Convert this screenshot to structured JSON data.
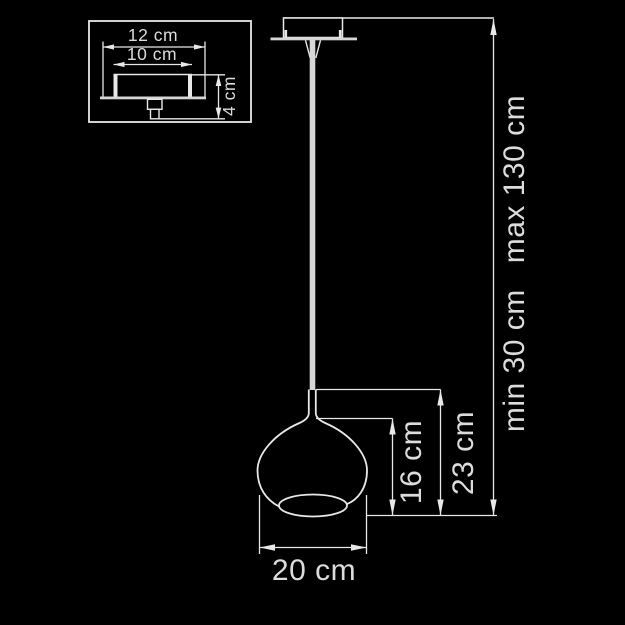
{
  "diagram": {
    "background_color": "#000000",
    "line_color": "#e8e8e8",
    "text_color": "#dcdcdc",
    "cord_color": "#d6d6d6",
    "canopy_detail": {
      "outer_width_label": "12 cm",
      "inner_width_label": "10 cm",
      "height_label": "4 cm"
    },
    "pendant": {
      "shade_diameter_label": "20 cm",
      "shade_height_label": "16 cm",
      "lamp_height_label": "23 cm",
      "suspension_min_label": "min 30 cm",
      "suspension_max_label": "max 130 cm"
    }
  }
}
